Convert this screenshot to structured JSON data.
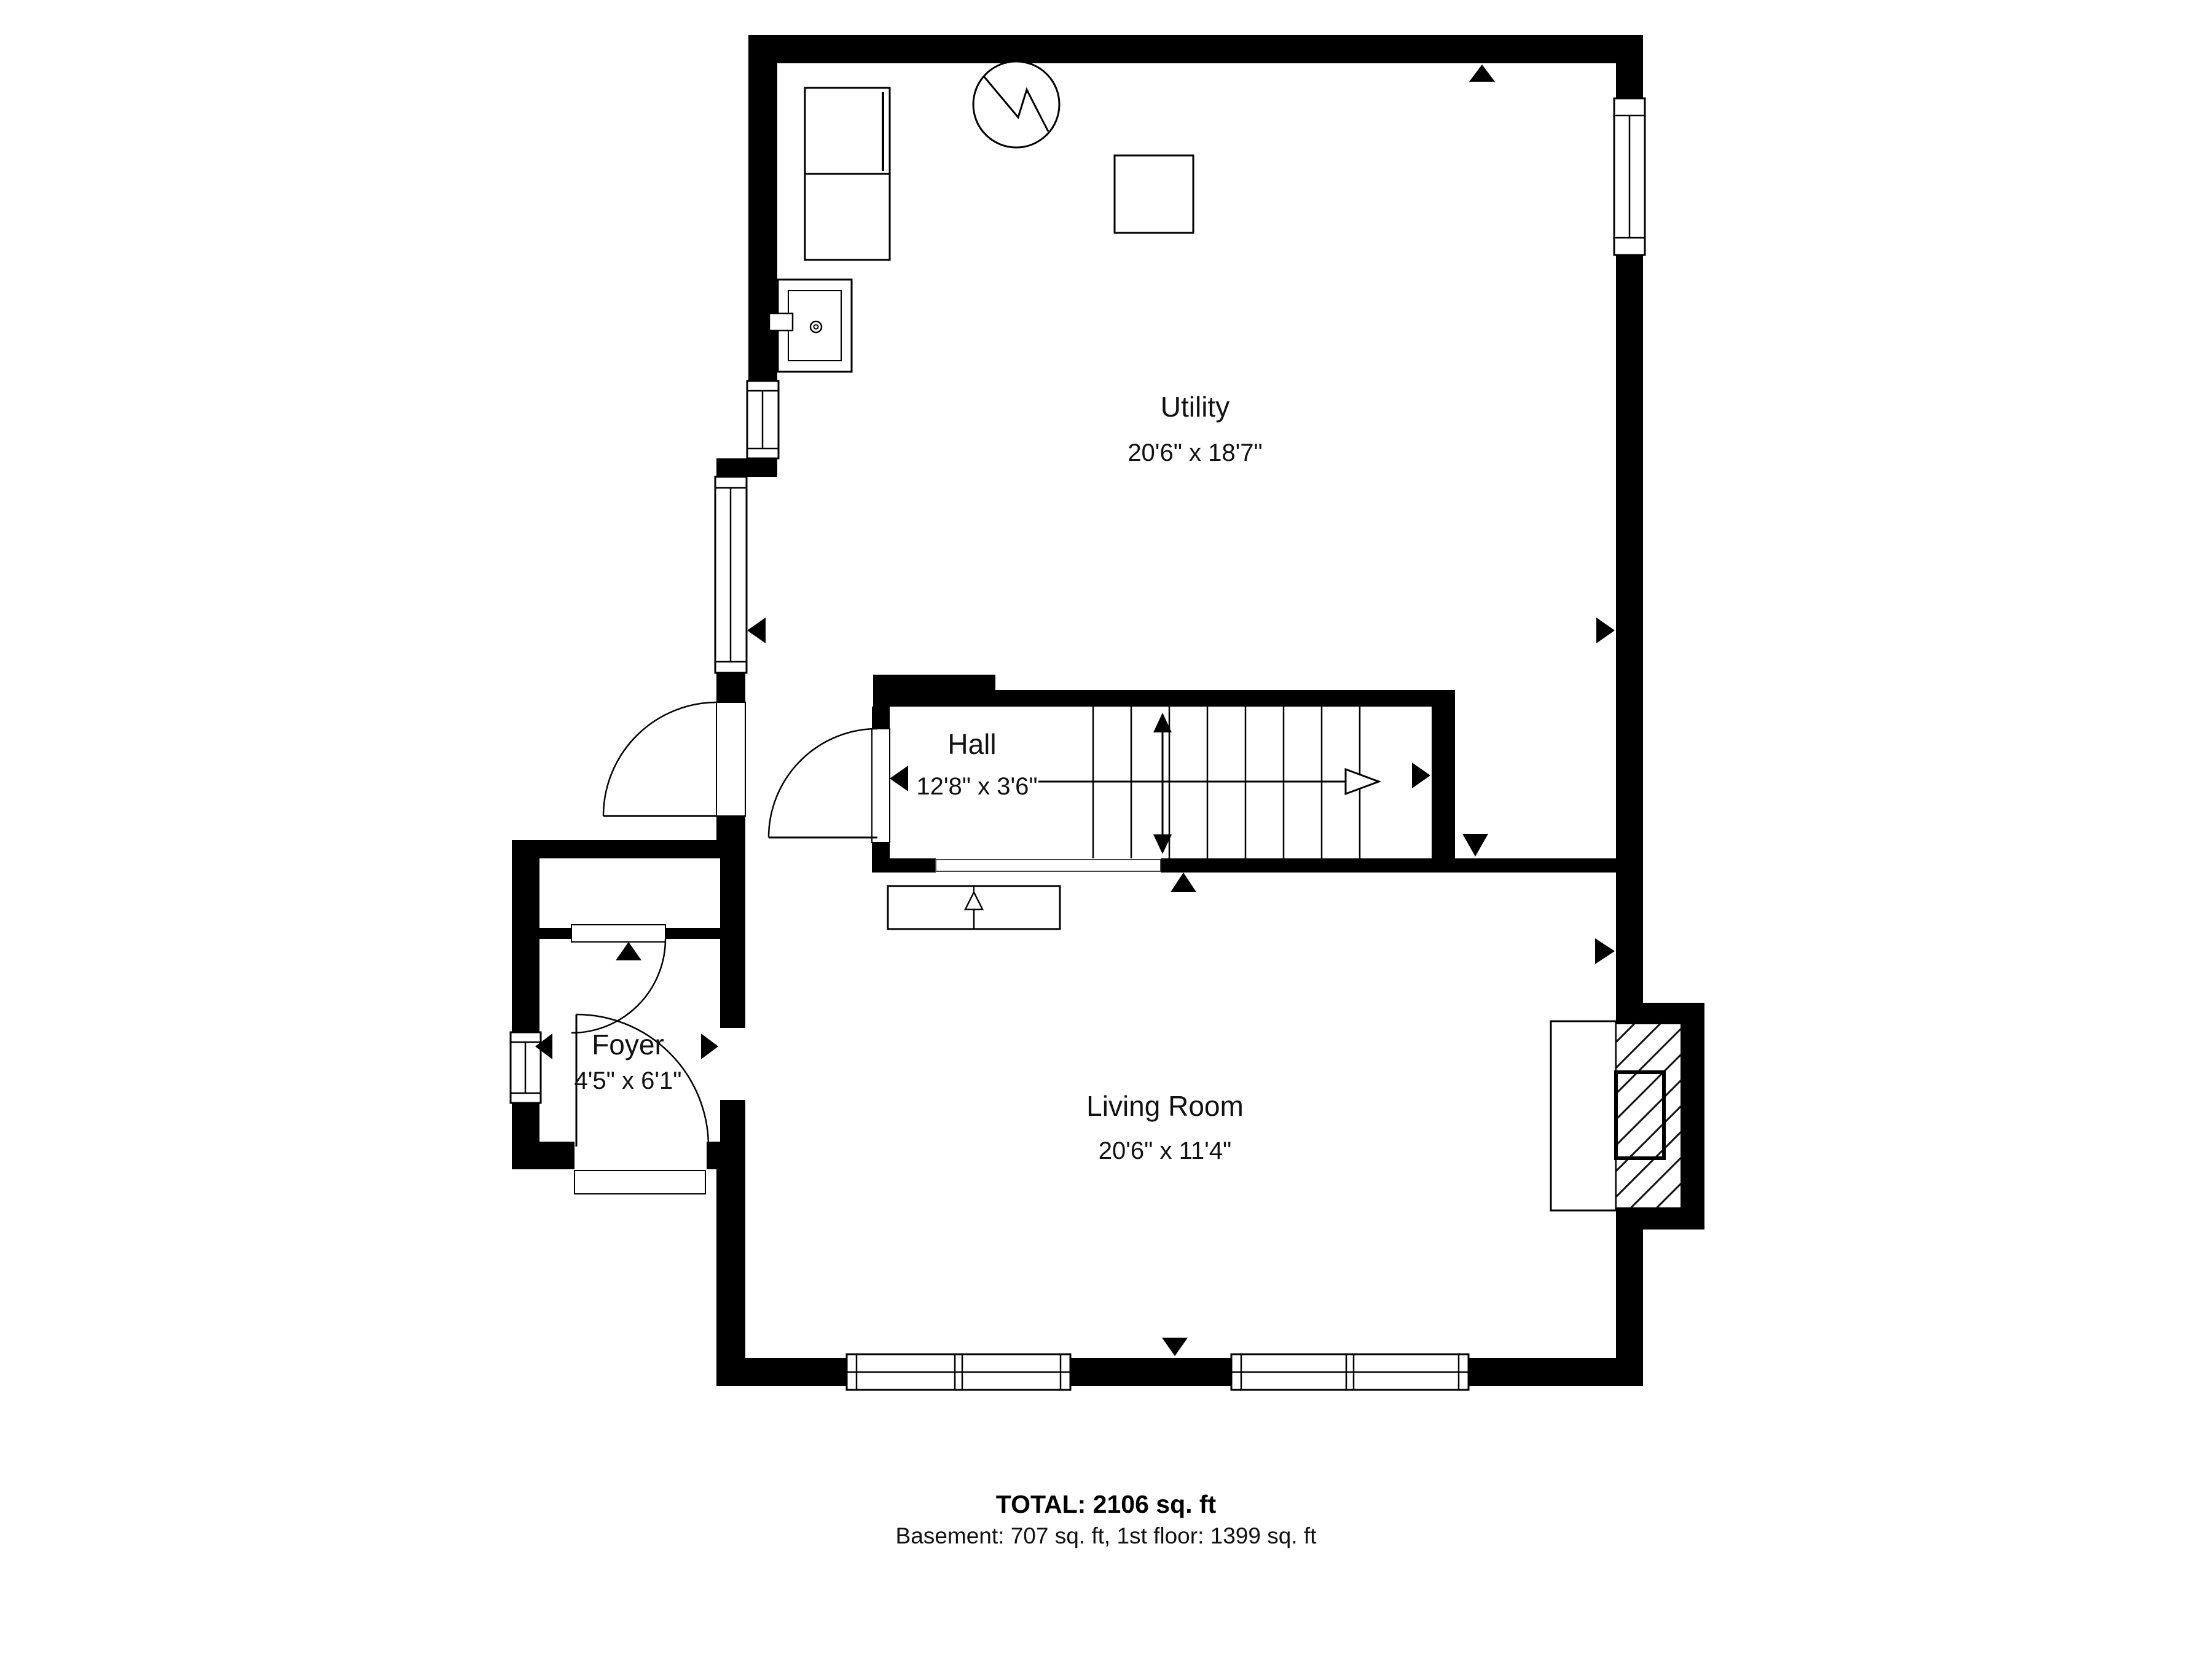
{
  "plan": {
    "type": "floorplan",
    "rooms": [
      {
        "name": "Utility",
        "dims": "20'6\" x 18'7\""
      },
      {
        "name": "Hall",
        "dims": "12'8\" x 3'6\""
      },
      {
        "name": "Living Room",
        "dims": "20'6\" x 11'4\""
      },
      {
        "name": "Foyer",
        "dims": "4'5\" x 6'1\""
      }
    ],
    "summary": {
      "total": "TOTAL: 2106 sq. ft",
      "breakdown": "Basement: 707 sq. ft, 1st floor: 1399 sq. ft"
    },
    "colors": {
      "wall": "#000000",
      "background": "#ffffff",
      "line": "#111111"
    },
    "icons": [
      "electrical-panel-icon",
      "water-heater-icon",
      "laundry-sink-icon",
      "appliance-icon",
      "fireplace-hearth-icon",
      "stairs-icon",
      "stair-direction-arrow-icon",
      "stairs-up-arrow-icon",
      "door-swing-icon",
      "window-icon",
      "opening-marker-icon"
    ]
  }
}
